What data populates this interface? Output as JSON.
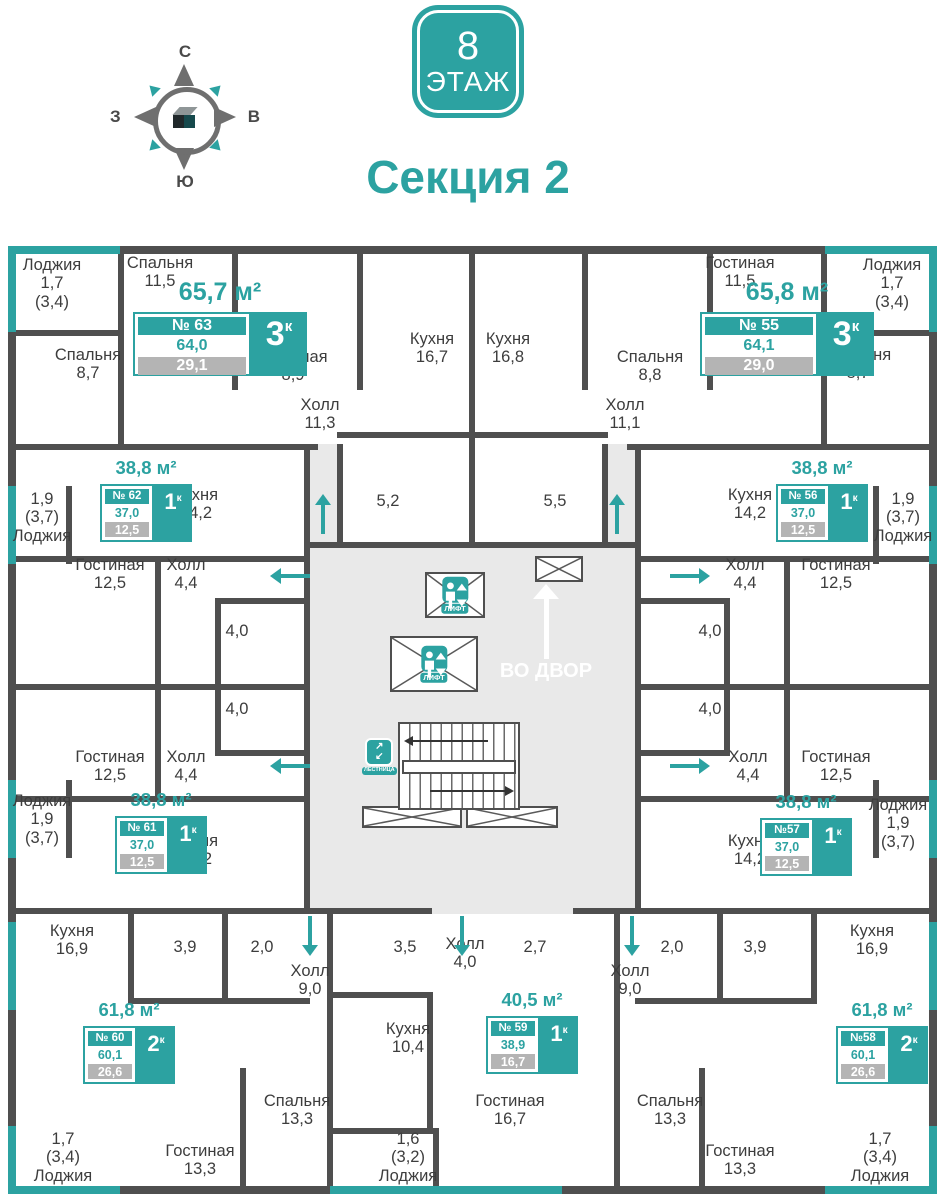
{
  "header": {
    "floor_badge": {
      "number": "8",
      "label": "ЭТАЖ"
    },
    "section_title": "Секция 2",
    "compass": {
      "n": "С",
      "e": "В",
      "s": "Ю",
      "w": "З"
    }
  },
  "colors": {
    "teal": "#2ca2a1",
    "wall": "#4f4f4f",
    "gray_badge": "#b4b4b4",
    "core_bg": "#e9e9e9"
  },
  "core": {
    "lift": "ЛИФТ",
    "stairs": "ЛЕСТНИЦА",
    "courtyard": "ВО ДВОР"
  },
  "apartments": [
    {
      "num": "№ 63",
      "rooms": "3",
      "sup": "к",
      "total": "65,7 м²",
      "a1": "64,0",
      "a2": "29,1"
    },
    {
      "num": "№ 55",
      "rooms": "3",
      "sup": "к",
      "total": "65,8 м²",
      "a1": "64,1",
      "a2": "29,0"
    },
    {
      "num": "№ 62",
      "rooms": "1",
      "sup": "к",
      "total": "38,8 м²",
      "a1": "37,0",
      "a2": "12,5"
    },
    {
      "num": "№ 56",
      "rooms": "1",
      "sup": "к",
      "total": "38,8 м²",
      "a1": "37,0",
      "a2": "12,5"
    },
    {
      "num": "№ 61",
      "rooms": "1",
      "sup": "к",
      "total": "38,8 м²",
      "a1": "37,0",
      "a2": "12,5"
    },
    {
      "num": "№57",
      "rooms": "1",
      "sup": "к",
      "total": "38,8 м²",
      "a1": "37,0",
      "a2": "12,5"
    },
    {
      "num": "№ 60",
      "rooms": "2",
      "sup": "к",
      "total": "61,8 м²",
      "a1": "60,1",
      "a2": "26,6"
    },
    {
      "num": "№58",
      "rooms": "2",
      "sup": "к",
      "total": "61,8 м²",
      "a1": "60,1",
      "a2": "26,6"
    },
    {
      "num": "№ 59",
      "rooms": "1",
      "sup": "к",
      "total": "40,5 м²",
      "a1": "38,9",
      "a2": "16,7"
    }
  ],
  "rooms": [
    {
      "x": 52,
      "y": 256,
      "lines": [
        "Лоджия",
        "1,7",
        "(3,4)"
      ]
    },
    {
      "x": 160,
      "y": 254,
      "lines": [
        "Спальня",
        "11,5"
      ]
    },
    {
      "x": 88,
      "y": 346,
      "lines": [
        "Спальня",
        "8,7"
      ]
    },
    {
      "x": 293,
      "y": 348,
      "lines": [
        "Гостиная",
        "8,9"
      ]
    },
    {
      "x": 432,
      "y": 330,
      "lines": [
        "Кухня",
        "16,7"
      ]
    },
    {
      "x": 508,
      "y": 330,
      "lines": [
        "Кухня",
        "16,8"
      ]
    },
    {
      "x": 320,
      "y": 396,
      "lines": [
        "Холл",
        "11,3"
      ]
    },
    {
      "x": 625,
      "y": 396,
      "lines": [
        "Холл",
        "11,1"
      ]
    },
    {
      "x": 388,
      "y": 492,
      "lines": [
        "5,2"
      ]
    },
    {
      "x": 555,
      "y": 492,
      "lines": [
        "5,5"
      ]
    },
    {
      "x": 740,
      "y": 254,
      "lines": [
        "Гостиная",
        "11,5"
      ]
    },
    {
      "x": 892,
      "y": 256,
      "lines": [
        "Лоджия",
        "1,7",
        "(3,4)"
      ]
    },
    {
      "x": 650,
      "y": 348,
      "lines": [
        "Спальня",
        "8,8"
      ]
    },
    {
      "x": 858,
      "y": 346,
      "lines": [
        "Спальня",
        "8,7"
      ]
    },
    {
      "x": 42,
      "y": 490,
      "lines": [
        "1,9",
        "(3,7)",
        "Лоджия"
      ]
    },
    {
      "x": 196,
      "y": 486,
      "lines": [
        "Кухня",
        "14,2"
      ]
    },
    {
      "x": 110,
      "y": 556,
      "lines": [
        "Гостиная",
        "12,5"
      ]
    },
    {
      "x": 186,
      "y": 556,
      "lines": [
        "Холл",
        "4,4"
      ]
    },
    {
      "x": 237,
      "y": 622,
      "lines": [
        "4,0"
      ]
    },
    {
      "x": 237,
      "y": 700,
      "lines": [
        "4,0"
      ]
    },
    {
      "x": 110,
      "y": 748,
      "lines": [
        "Гостиная",
        "12,5"
      ]
    },
    {
      "x": 186,
      "y": 748,
      "lines": [
        "Холл",
        "4,4"
      ]
    },
    {
      "x": 750,
      "y": 486,
      "lines": [
        "Кухня",
        "14,2"
      ]
    },
    {
      "x": 903,
      "y": 490,
      "lines": [
        "1,9",
        "(3,7)",
        "Лоджия"
      ]
    },
    {
      "x": 745,
      "y": 556,
      "lines": [
        "Холл",
        "4,4"
      ]
    },
    {
      "x": 836,
      "y": 556,
      "lines": [
        "Гостиная",
        "12,5"
      ]
    },
    {
      "x": 710,
      "y": 622,
      "lines": [
        "4,0"
      ]
    },
    {
      "x": 710,
      "y": 700,
      "lines": [
        "4,0"
      ]
    },
    {
      "x": 748,
      "y": 748,
      "lines": [
        "Холл",
        "4,4"
      ]
    },
    {
      "x": 836,
      "y": 748,
      "lines": [
        "Гостиная",
        "12,5"
      ]
    },
    {
      "x": 196,
      "y": 832,
      "lines": [
        "Кухня",
        "14,2"
      ]
    },
    {
      "x": 42,
      "y": 792,
      "lines": [
        "Лоджия",
        "1,9",
        "(3,7)"
      ]
    },
    {
      "x": 750,
      "y": 832,
      "lines": [
        "Кухня",
        "14,2"
      ]
    },
    {
      "x": 898,
      "y": 796,
      "lines": [
        "Лоджия",
        "1,9",
        "(3,7)"
      ]
    },
    {
      "x": 72,
      "y": 922,
      "lines": [
        "Кухня",
        "16,9"
      ]
    },
    {
      "x": 185,
      "y": 938,
      "lines": [
        "3,9"
      ]
    },
    {
      "x": 262,
      "y": 938,
      "lines": [
        "2,0"
      ]
    },
    {
      "x": 310,
      "y": 962,
      "lines": [
        "Холл",
        "9,0"
      ]
    },
    {
      "x": 405,
      "y": 938,
      "lines": [
        "3,5"
      ]
    },
    {
      "x": 465,
      "y": 935,
      "lines": [
        "Холл",
        "4,0"
      ]
    },
    {
      "x": 535,
      "y": 938,
      "lines": [
        "2,7"
      ]
    },
    {
      "x": 672,
      "y": 938,
      "lines": [
        "2,0"
      ]
    },
    {
      "x": 755,
      "y": 938,
      "lines": [
        "3,9"
      ]
    },
    {
      "x": 630,
      "y": 962,
      "lines": [
        "Холл",
        "9,0"
      ]
    },
    {
      "x": 872,
      "y": 922,
      "lines": [
        "Кухня",
        "16,9"
      ]
    },
    {
      "x": 408,
      "y": 1020,
      "lines": [
        "Кухня",
        "10,4"
      ]
    },
    {
      "x": 297,
      "y": 1092,
      "lines": [
        "Спальня",
        "13,3"
      ]
    },
    {
      "x": 510,
      "y": 1092,
      "lines": [
        "Гостиная",
        "16,7"
      ]
    },
    {
      "x": 200,
      "y": 1142,
      "lines": [
        "Гостиная",
        "13,3"
      ]
    },
    {
      "x": 63,
      "y": 1130,
      "lines": [
        "1,7",
        "(3,4)",
        "Лоджия"
      ]
    },
    {
      "x": 408,
      "y": 1130,
      "lines": [
        "1,6",
        "(3,2)",
        "Лоджия"
      ]
    },
    {
      "x": 670,
      "y": 1092,
      "lines": [
        "Спальня",
        "13,3"
      ]
    },
    {
      "x": 740,
      "y": 1142,
      "lines": [
        "Гостиная",
        "13,3"
      ]
    },
    {
      "x": 880,
      "y": 1130,
      "lines": [
        "1,7",
        "(3,4)",
        "Лоджия"
      ]
    }
  ],
  "entry_arrows": [
    {
      "x": 323,
      "y": 494,
      "dir": "up"
    },
    {
      "x": 617,
      "y": 494,
      "dir": "up"
    },
    {
      "x": 270,
      "y": 576,
      "dir": "left"
    },
    {
      "x": 270,
      "y": 766,
      "dir": "left"
    },
    {
      "x": 670,
      "y": 576,
      "dir": "right"
    },
    {
      "x": 670,
      "y": 766,
      "dir": "right"
    },
    {
      "x": 310,
      "y": 916,
      "dir": "down"
    },
    {
      "x": 462,
      "y": 916,
      "dir": "down"
    },
    {
      "x": 632,
      "y": 916,
      "dir": "down"
    }
  ]
}
